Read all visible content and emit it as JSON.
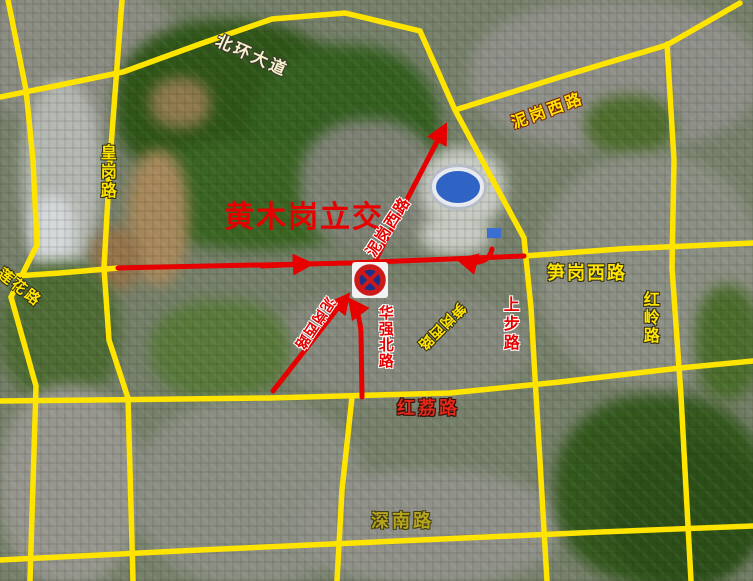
{
  "map": {
    "type": "annotated-satellite-map",
    "interchange_title": "黄木岗立交",
    "sign": {
      "name": "no-stopping-sign",
      "meaning": "禁止停车"
    }
  },
  "labels": {
    "beihuan": "北环大道",
    "huanggang": "皇岗路",
    "lianhua": "莲花路",
    "title": "黄木岗立交",
    "nigang_arrow": "泥岗西路",
    "nigang_yellow": "泥岗西路",
    "sungang": "笋岗西路",
    "sungang_flipped": "笋岗西路",
    "hongling": "红岭路",
    "shangbu": "上步路",
    "huaqiangbei": "华强北路",
    "nigang_flipped": "泥岗西路",
    "hongli": "红荔路",
    "shennan": "深南路"
  },
  "colors": {
    "road_grid_yellow": "#ffe400",
    "arrow_red": "#e60000",
    "title_red": "#e60000",
    "sign_blue": "#1e2f86",
    "sign_ring_red": "#cc1a1a",
    "forest_green": "#2f5618",
    "urban_gray": "#8c9084"
  }
}
